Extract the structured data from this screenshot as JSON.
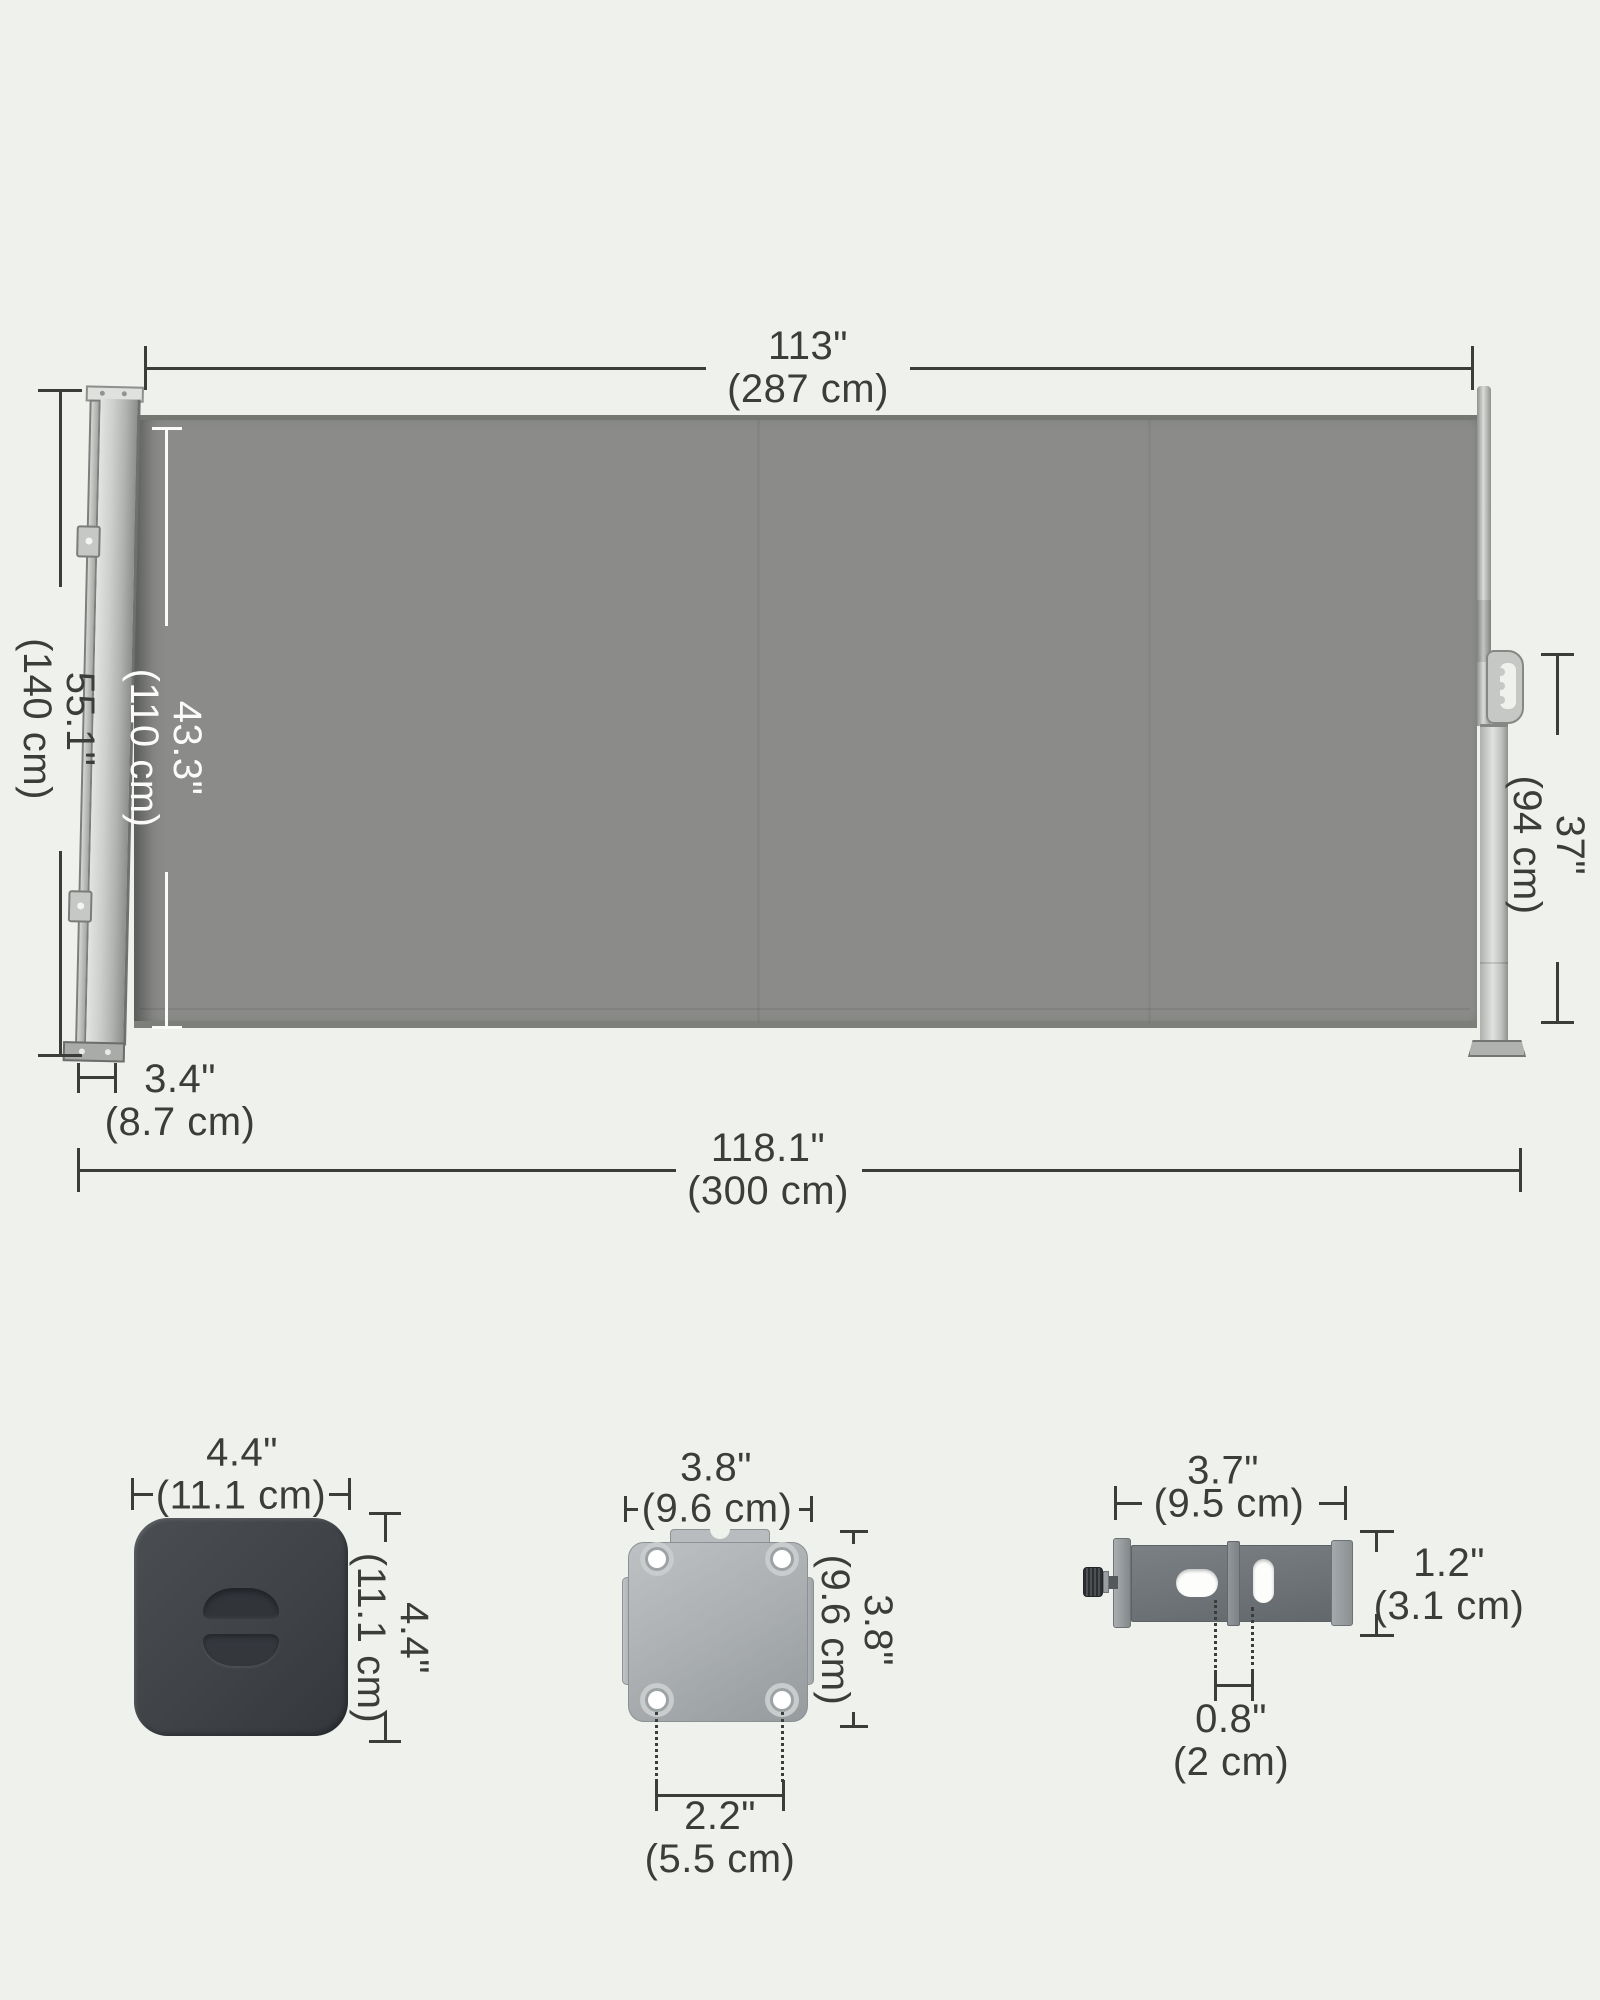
{
  "product": "retractable side awning dimension diagram",
  "colors": {
    "background": "#eff1ed",
    "fabric": "#8b8c8a",
    "dimension_line": "#3a3d3a",
    "white_label": "#fbfcfa",
    "end_cap": "#3f4347",
    "metal_light": "#c9cbc9",
    "bracket_body": "#6f747a"
  },
  "awning": {
    "extension_width": {
      "inches": "113\"",
      "metric": "(287 cm)"
    },
    "total_height": {
      "inches": "55.1\"",
      "metric": "(140 cm)"
    },
    "fabric_height": {
      "inches": "43.3\"",
      "metric": "(110 cm)"
    },
    "pole_height": {
      "inches": "37\"",
      "metric": "(94 cm)"
    },
    "housing_depth": {
      "inches": "3.4\"",
      "metric": "(8.7 cm)"
    },
    "total_width": {
      "inches": "118.1\"",
      "metric": "(300 cm)"
    }
  },
  "end_cap": {
    "width": {
      "inches": "4.4\"",
      "metric": "(11.1 cm)"
    },
    "height": {
      "inches": "4.4\"",
      "metric": "(11.1 cm)"
    }
  },
  "mounting_plate": {
    "width": {
      "inches": "3.8\"",
      "metric": "(9.6 cm)"
    },
    "height": {
      "inches": "3.8\"",
      "metric": "(9.6 cm)"
    },
    "hole_spacing": {
      "inches": "2.2\"",
      "metric": "(5.5 cm)"
    }
  },
  "wall_bracket": {
    "width": {
      "inches": "3.7\"",
      "metric": "(9.5 cm)"
    },
    "height": {
      "inches": "1.2\"",
      "metric": "(3.1 cm)"
    },
    "slot_spacing": {
      "inches": "0.8\"",
      "metric": "(2 cm)"
    }
  }
}
